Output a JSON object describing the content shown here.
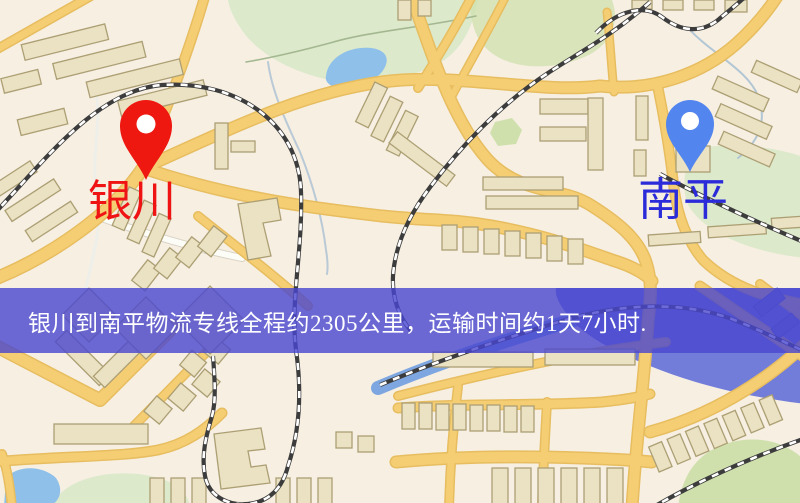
{
  "page": {
    "width": 800,
    "height": 503,
    "kind": "logistics-route-map"
  },
  "map": {
    "origin": {
      "label": "银川",
      "pin_icon": "red-map-pin-icon",
      "pin_color": "#ee1810",
      "label_color": "#f01313"
    },
    "destination": {
      "label": "南平",
      "pin_icon": "blue-map-pin-icon",
      "pin_color": "#5285ee",
      "label_color": "#2b2bd9"
    },
    "banner": {
      "text": "银川到南平物流专线全程约2305公里，运输时间约1天7小时.",
      "overlay_color": "rgba(72,70,208,0.8)",
      "text_color": "#ffffff"
    }
  },
  "palette": {
    "map_background": "#f6efe2",
    "road_fill": "#f5ce74",
    "road_casing": "#e7bd5f",
    "road_white": "#fdfdf8",
    "building_fill": "#ebe2c3",
    "building_stroke": "#ac9f74",
    "railway_dark": "#3c3c3c",
    "water_light": "#8fc0ea",
    "water_deep": "#727cd9",
    "river": "#7ea6e0",
    "park_green": "#dce9cb",
    "park_green_dark": "#cfe0ad",
    "banner_overlay": "rgba(72,70,208,0.8)",
    "banner_text": "#ffffff",
    "origin_label": "#f01313",
    "destination_label": "#2b2bd9"
  }
}
